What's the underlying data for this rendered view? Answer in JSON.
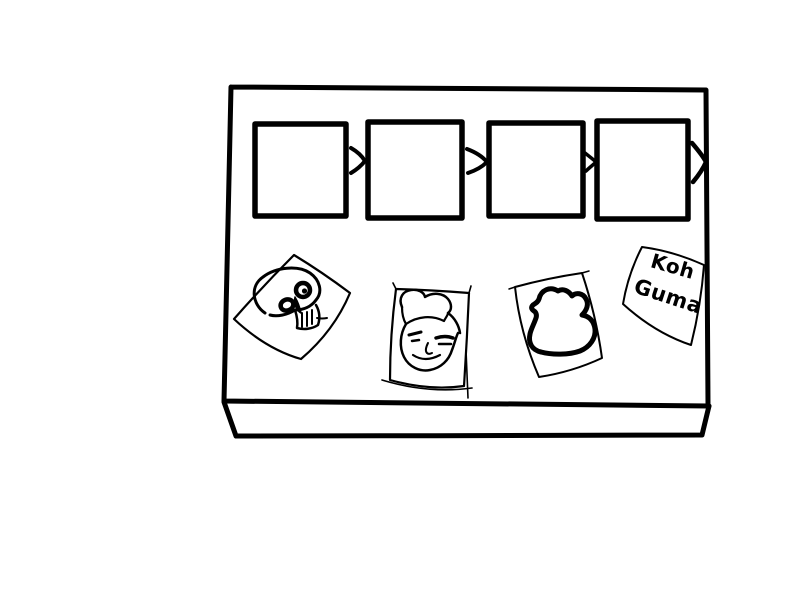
{
  "canvas": {
    "background_color": "#ffffff",
    "ink_color": "#000000"
  },
  "board": {
    "slots": [
      {
        "name": "slot-1",
        "content": ""
      },
      {
        "name": "slot-2",
        "content": ""
      },
      {
        "name": "slot-3",
        "content": ""
      },
      {
        "name": "slot-4",
        "content": ""
      }
    ],
    "arrow_glyph": ">",
    "arrow_count": 4,
    "arrow_direction": "right"
  },
  "cards": [
    {
      "name": "skull-card",
      "doodle": "skull"
    },
    {
      "name": "face-card",
      "doodle": "smirking-man-face"
    },
    {
      "name": "duck-card",
      "doodle": "rubber-duck-outline"
    },
    {
      "name": "text-card",
      "doodle": "handwriting",
      "line1": "Koh",
      "line2": "Guma"
    }
  ]
}
